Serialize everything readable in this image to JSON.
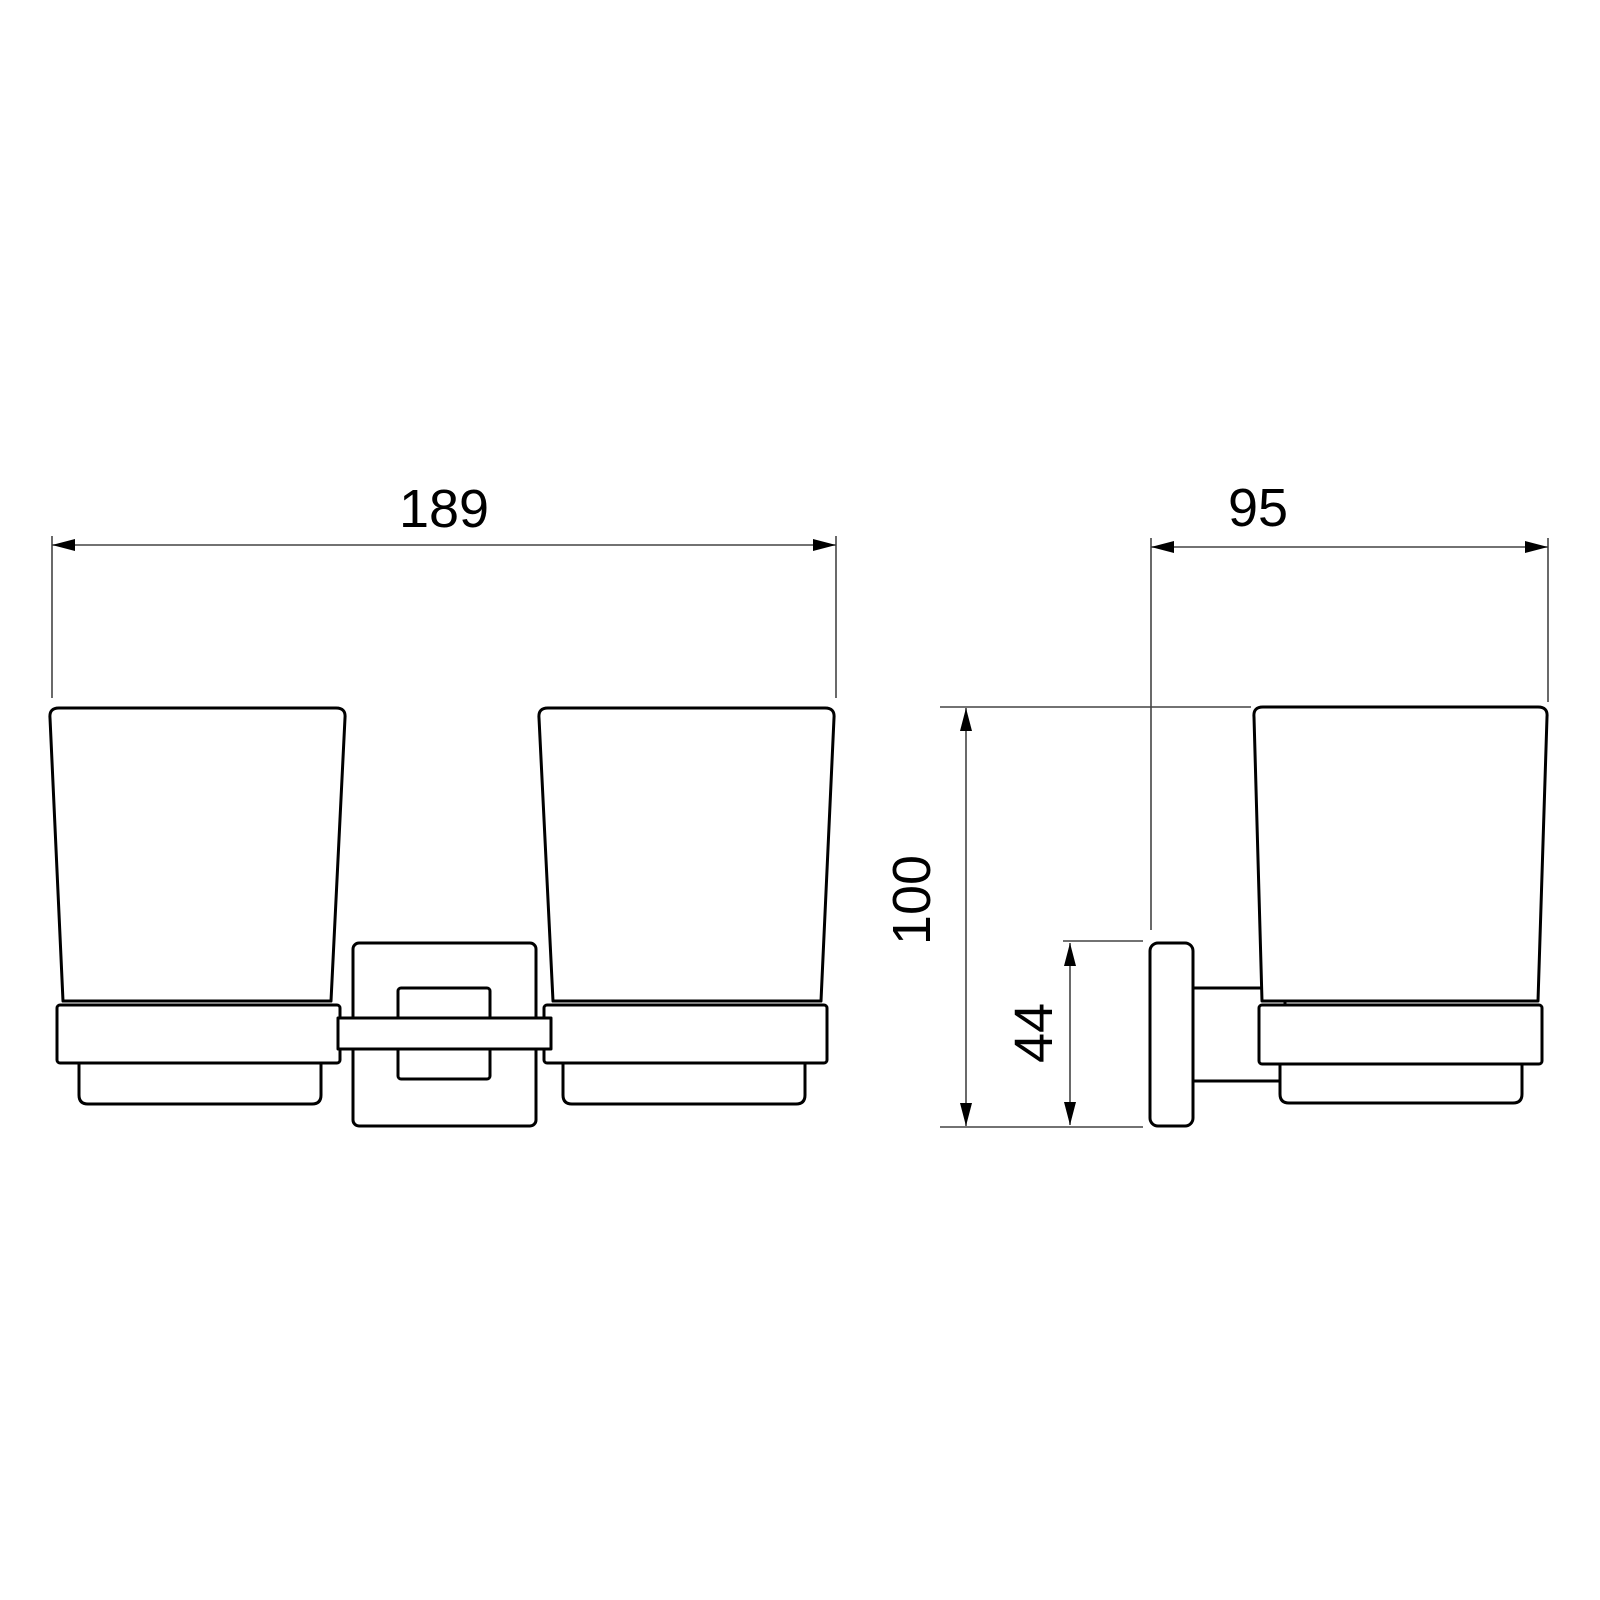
{
  "drawing": {
    "type": "technical-dimension-drawing",
    "subject": "double-tumbler-holder",
    "views": {
      "front": {
        "label_count": 1
      },
      "side": {
        "label_count": 3
      }
    }
  },
  "dimensions": {
    "overall_width": "189",
    "depth": "95",
    "overall_height": "100",
    "bracket_height": "44"
  },
  "colors": {
    "background": "#ffffff",
    "object_line": "#000000",
    "dimension_line": "#444444",
    "text": "#000000"
  }
}
